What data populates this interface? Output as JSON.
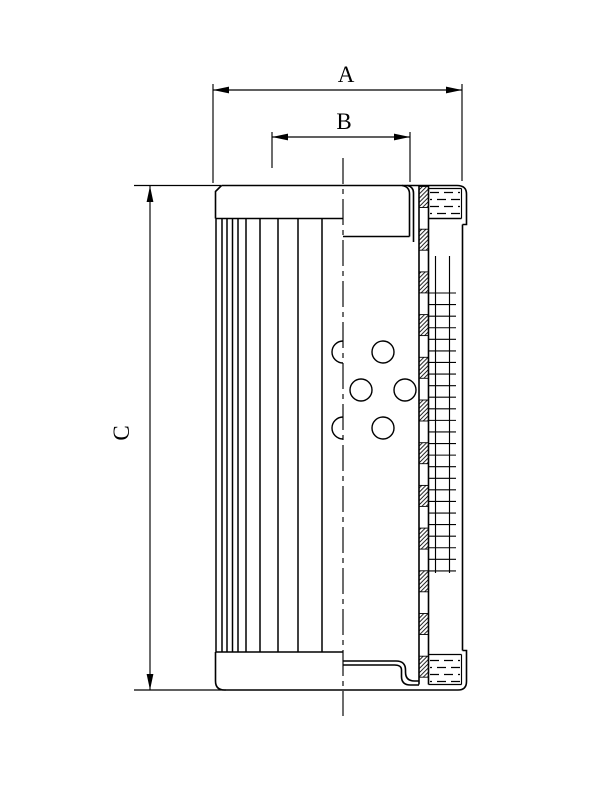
{
  "page": {
    "background": "#ffffff",
    "line_color": "#000000"
  },
  "dimensions": {
    "a": {
      "label": "A"
    },
    "b": {
      "label": "B"
    },
    "c": {
      "label": "C"
    }
  }
}
